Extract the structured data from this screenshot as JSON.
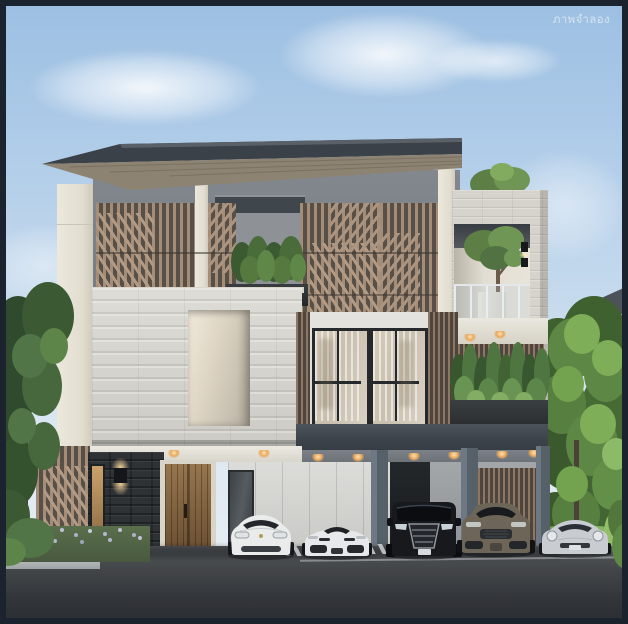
{
  "watermark": {
    "text": "ภาพจำลอง"
  },
  "scene": {
    "type": "exterior-architectural-rendering",
    "subject": "modern three-storey house with wood slat screens, travertine stone facade, terrace tree, hedge balcony and carport with five parked cars",
    "palette": {
      "frame_border": "#1a232e",
      "sky_top": "#9cbfe2",
      "sky_horizon": "#eaf0f5",
      "roof_slab": "#3b4148",
      "roof_soffit_wood": "#8d8373",
      "upper_wall_gray": "#7b8187",
      "slat_wood": "#a38d79",
      "cream_trim": "#ece8dc",
      "stone_light": "#d8d7d1",
      "charcoal_stone": "#2e3235",
      "window_frame": "#26292c",
      "glass_reflection": "#cfc3ae",
      "hedge_green": "#4c6b3a",
      "tree_green_sunlit": "#7fae58",
      "floor_slab_band": "#3d444c",
      "carport_soffit": "#6b7177",
      "panel_wall": "#d6d6d3",
      "column_gray": "#5f6872",
      "door_wood": "#86643f",
      "asphalt": "#323539",
      "downlight_warm": "#ffd9a0",
      "curb": "#9da2a3",
      "flower_lavender": "#c0c1d6"
    },
    "cars": [
      {
        "label": "white electric sedan",
        "body_color": "#eaecec"
      },
      {
        "label": "white sports car",
        "body_color": "#e7e8e9"
      },
      {
        "label": "black luxury van",
        "body_color": "#17191d"
      },
      {
        "label": "bronze suv",
        "body_color": "#6e6559"
      },
      {
        "label": "silver coupe",
        "body_color": "#c9cdd1"
      }
    ]
  }
}
